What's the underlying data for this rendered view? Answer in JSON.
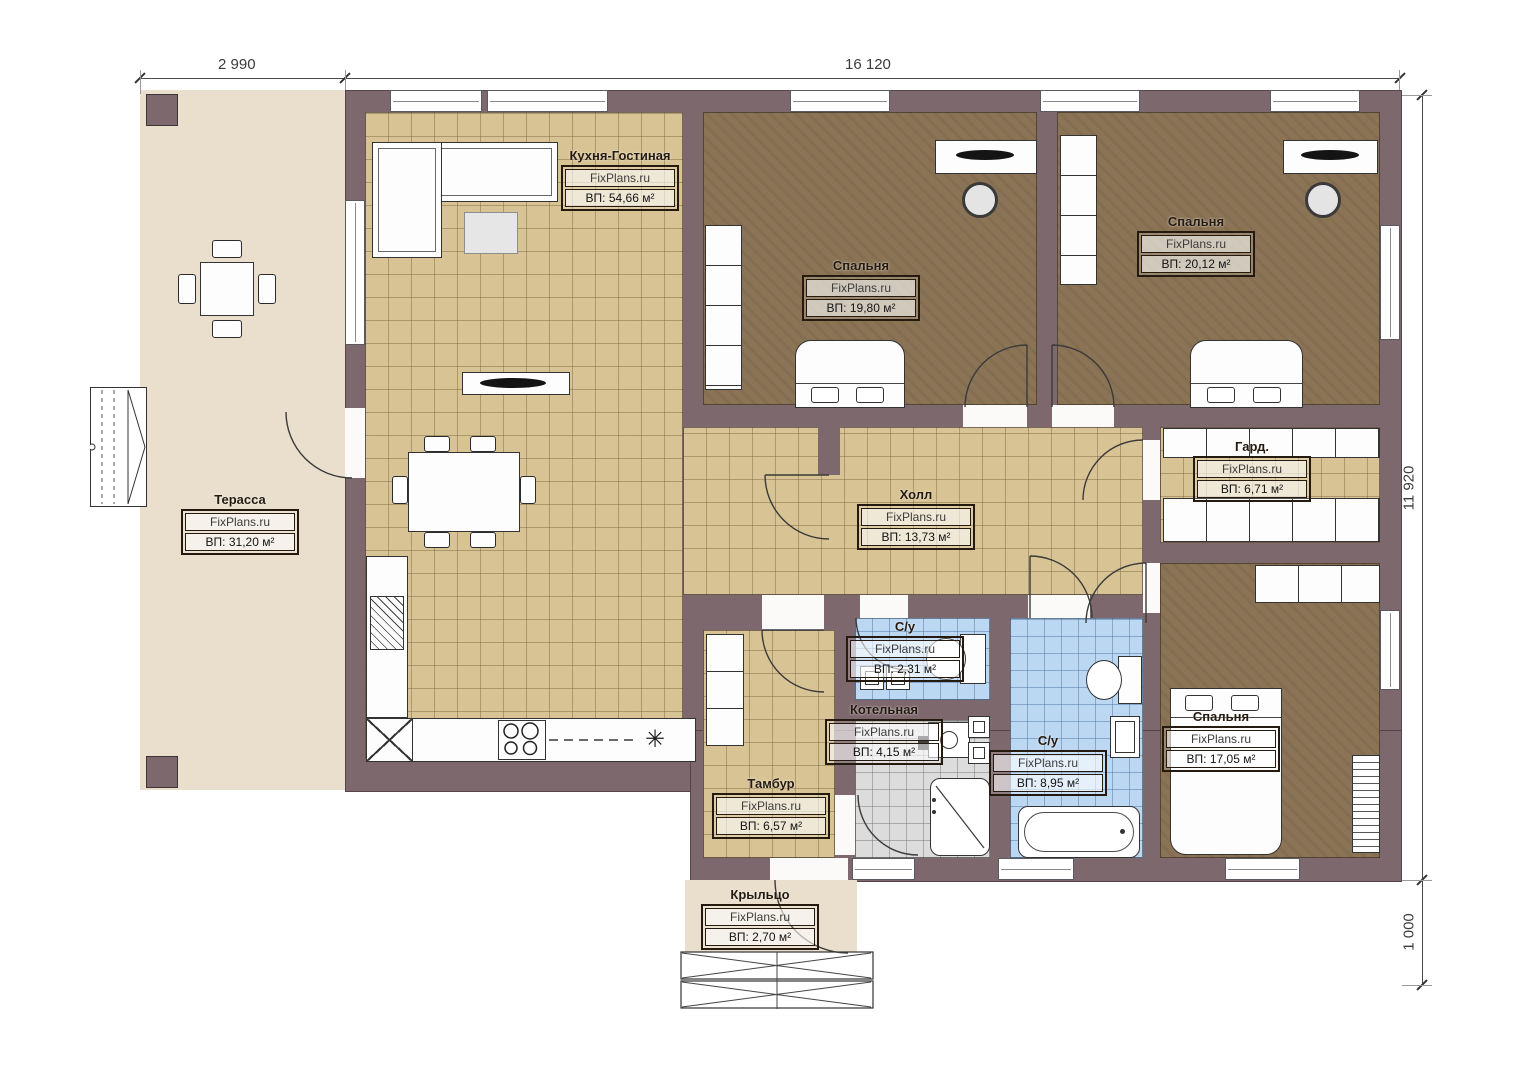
{
  "watermark": "FixPlans.ru",
  "dimensions": {
    "top_left": "2 990",
    "top_main": "16 120",
    "right_main": "11 920",
    "right_porch": "1 000"
  },
  "rooms": {
    "terrace": {
      "name": "Терасса",
      "area": "ВП: 31,20 м²"
    },
    "kitchen_living": {
      "name": "Кухня-Гостиная",
      "area": "ВП: 54,66 м²"
    },
    "bedroom1": {
      "name": "Спальня",
      "area": "ВП: 19,80 м²"
    },
    "bedroom2": {
      "name": "Спальня",
      "area": "ВП: 20,12 м²"
    },
    "hall": {
      "name": "Холл",
      "area": "ВП: 13,73 м²"
    },
    "wardrobe": {
      "name": "Гард.",
      "area": "ВП: 6,71 м²"
    },
    "bathroom_small": {
      "name": "С/у",
      "area": "ВП: 2,31 м²"
    },
    "boiler": {
      "name": "Котельная",
      "area": "ВП: 4,15 м²"
    },
    "bathroom_big": {
      "name": "С/у",
      "area": "ВП: 8,95 м²"
    },
    "bedroom3": {
      "name": "Спальня",
      "area": "ВП: 17,05 м²"
    },
    "vestibule": {
      "name": "Тамбур",
      "area": "ВП: 6,57 м²"
    },
    "porch": {
      "name": "Крыльцо",
      "area": "ВП: 2,70 м²"
    }
  },
  "icons": {
    "fridge_symbol": "✳"
  },
  "colors": {
    "wall": "#7d686e",
    "tile_floor": "#d8c394",
    "bedroom_floor": "#8b7455",
    "terrace_floor": "#e9dfcc",
    "bath_tile": "#bcd7f1",
    "utility_tile": "#dcdcdc"
  }
}
